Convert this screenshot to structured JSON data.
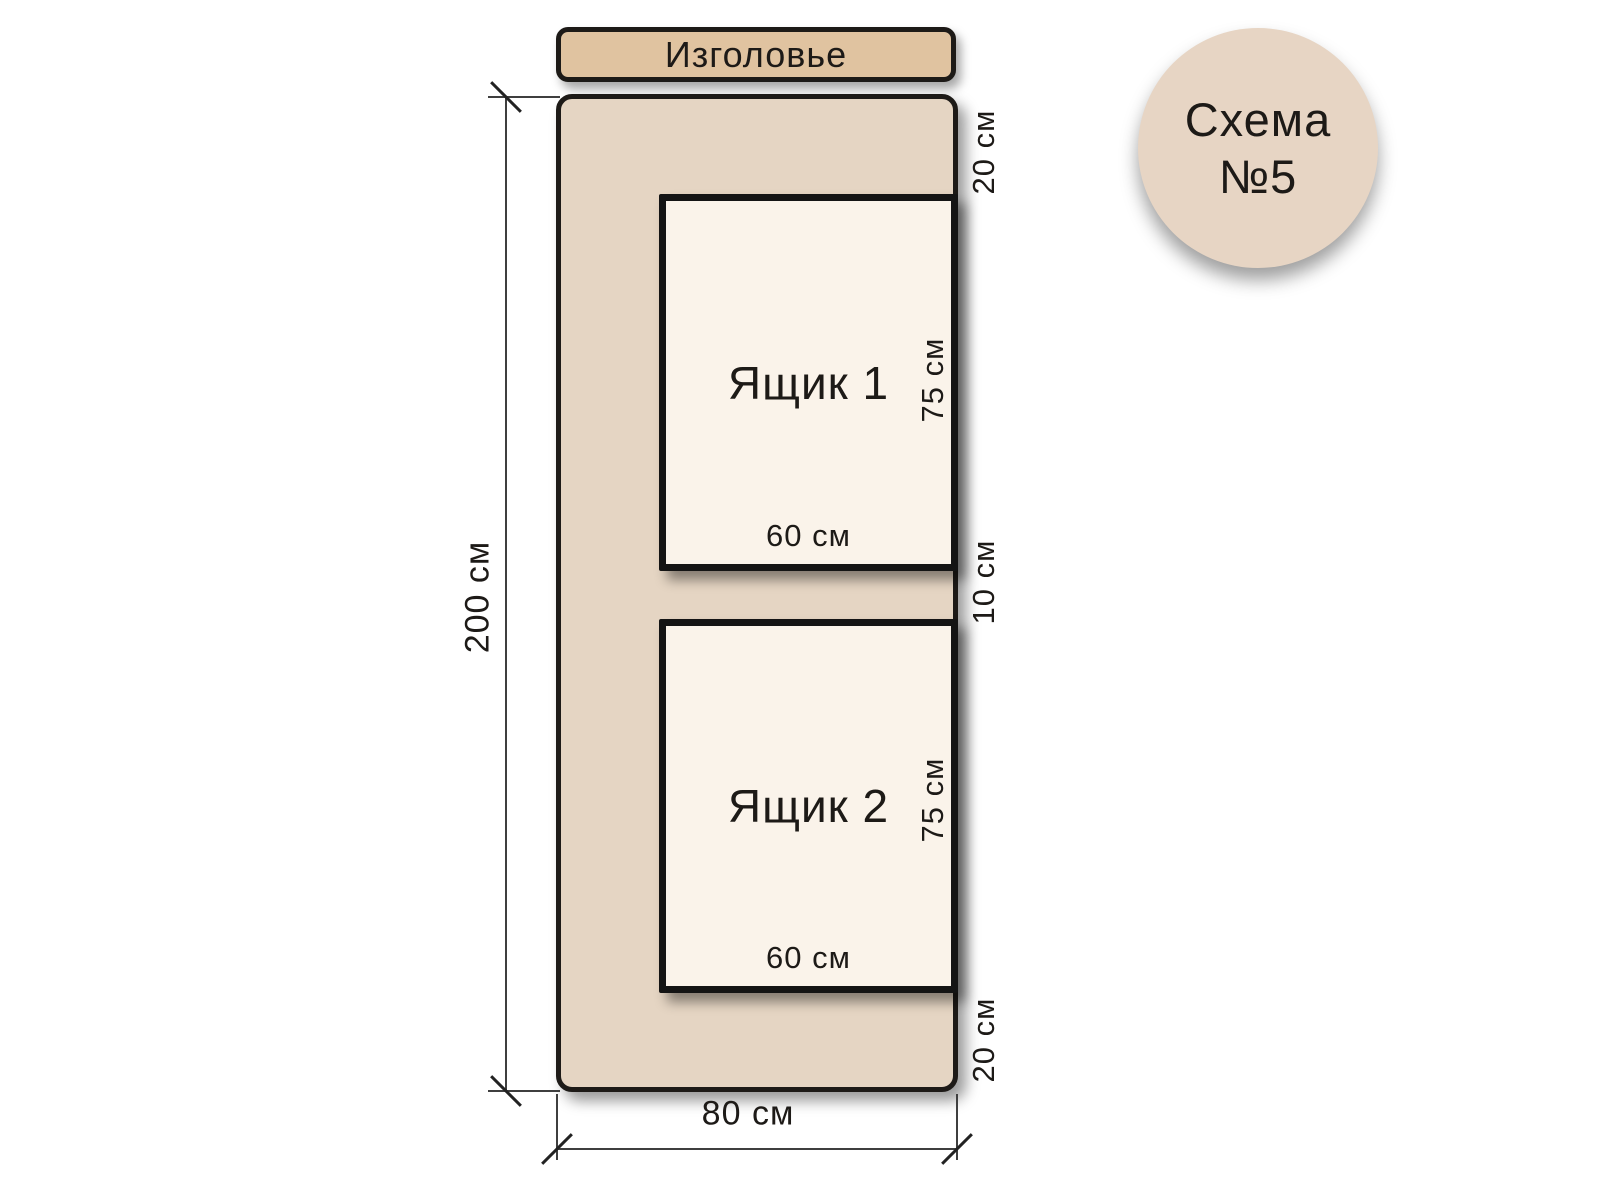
{
  "badge": {
    "line1": "Схема",
    "line2": "№5"
  },
  "headboard": {
    "label": "Изголовье"
  },
  "dims": {
    "bed_height": "200 см",
    "bed_width": "80 см",
    "top_offset": "20 см",
    "middle_gap": "10 см",
    "bottom_offset": "20 см"
  },
  "drawers": [
    {
      "label": "Ящик 1",
      "width_label": "60 см",
      "height_label": "75 см"
    },
    {
      "label": "Ящик 2",
      "width_label": "60 см",
      "height_label": "75 см"
    }
  ],
  "colors": {
    "background": "#ffffff",
    "outline": "#1d1a17",
    "bed_fill": "#e5d5c3",
    "headboard_fill": "#e0c3a0",
    "drawer_fill": "#faf3ea",
    "badge_fill": "#e7d5c4",
    "text": "#1d1a17",
    "dim_line": "#3f3f3f"
  }
}
